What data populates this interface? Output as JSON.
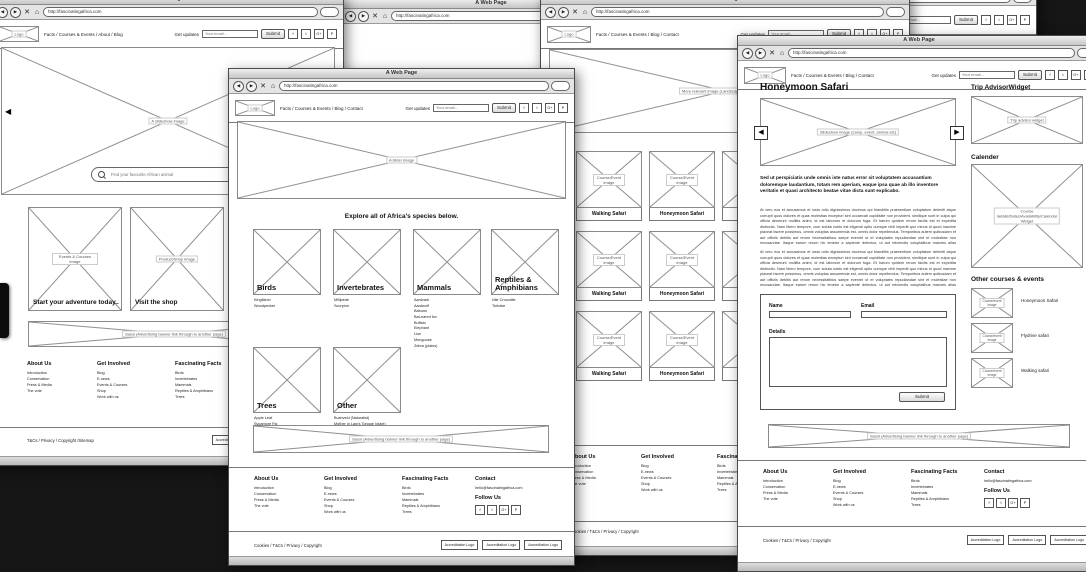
{
  "chrome": {
    "title": "A Web Page",
    "url": "http://fascinatingafrica.com",
    "back": "◀",
    "forward": "▶",
    "close": "✕",
    "home": "⌂"
  },
  "header": {
    "logo_caption": "Logo",
    "nav_home": "Facts / Courses & Events / About / Blog",
    "nav_inner": "Facts / Courses & Events / Blog / Contact",
    "updates_label": "Get updates",
    "email_placeholder": "Your email...",
    "submit_label": "Submit",
    "social": [
      "f",
      "t",
      "G+",
      "P"
    ]
  },
  "footer": {
    "about": {
      "title": "About Us",
      "links": [
        "Introduction",
        "Conservation",
        "Press & Media",
        "The vote"
      ]
    },
    "involved": {
      "title": "Get Involved",
      "links": [
        "Blog",
        "E-news",
        "Events & Courses",
        "Shop",
        "Work with us"
      ]
    },
    "facts": {
      "title": "Fascinating Facts",
      "links": [
        "Birds",
        "Invertebrates",
        "Mammals",
        "Reptiles & Amphibians",
        "Trees"
      ]
    },
    "contact": {
      "title": "Contact",
      "email": "hello@fascinatingafrica.com",
      "follow": "Follow Us",
      "social": [
        "f",
        "t",
        "G+",
        "P"
      ]
    },
    "legal_inner": "Cookies / T&Cs / Privacy / Copyright",
    "legal_home": "T&Cs / Privacy / Copyright /Sitemap",
    "accreditation_label": "Accreditation Logo"
  },
  "banner": {
    "caption": "Sasol (Advertising banner link through to another page)"
  },
  "home": {
    "hero_caption": "A slideshow image",
    "prev_icon": "◀",
    "search_placeholder": "Find your favourite African animal",
    "cards": [
      {
        "caption": "Events & Courses image",
        "label": "Start your adventure today.."
      },
      {
        "caption": "Product/Shop image",
        "label": "Visit the shop"
      }
    ]
  },
  "species": {
    "hero_caption": "A slider image",
    "heading": "Explore all of Africa's species below.",
    "cats": [
      {
        "name": "Birds",
        "items": [
          "Kingfisher",
          "Woodpecker"
        ]
      },
      {
        "name": "Invertebrates",
        "items": [
          "Millipede",
          "Scorpion"
        ]
      },
      {
        "name": "Mammals",
        "items": [
          "Aardvark",
          "Aardwolf",
          "Baboon",
          "Bat-eared fox",
          "Buffalo",
          "Elephant",
          "Lion",
          "Mongoose",
          "Zebra (plains)"
        ]
      },
      {
        "name": "Reptiles & Amphibians",
        "items": [
          "Nile Crocodile",
          "Tortoise"
        ]
      },
      {
        "name": "Trees",
        "items": [
          "Apple Leaf",
          "Sycamore Fig"
        ]
      },
      {
        "name": "Other",
        "items": [
          "Bushveld (Naturalist)",
          "Mother in Law's Tongue (plant)"
        ]
      }
    ]
  },
  "courses": {
    "hero_caption": "More relevant image (Landscape, people, safari)",
    "card_caption": "Course/Event image",
    "labels": [
      "Walking Safari",
      "Honeymoon Safari",
      "Flydrive Safari"
    ]
  },
  "detail": {
    "title": "Honeymoon Safari",
    "slideshow_caption": "Slideshow image (camp, event, animal etc)",
    "prev_icon": "◀",
    "next_icon": "▶",
    "intro": "Sed ut perspiciatis unde omnis iste natus error sit voluptatem accusantium doloremque laudantium, totam rem aperiam, eaque ipsa quae ab illo inventore veritatis et quasi architecto beatae vitae dicta sunt explicabo.",
    "para": "At vero eos et accusamus et iusto odio dignissimos ducimus qui blanditiis praesentium voluptatum deleniti atque corrupti quos dolores et quas molestias excepturi sint occaecati cupiditate non provident, similique sunt in culpa qui officia deserunt mollitia animi, id est laborum et dolorum fuga. Et harum quidem rerum facilis est et expedita distinctio. Nam libero tempore, cum soluta nobis est eligendi optio cumque nihil impedit quo minus id quod maxime placeat facere possimus, omnis voluptas assumenda est, omnis dolor repellendus. Temporibus autem quibusdam et aut officiis debitis aut rerum necessitatibus saepe eveniet ut et voluptates repudiandae sint et molestiae non recusandae. Itaque earum rerum hic tenetur a sapiente delectus, ut aut reiciendis voluptatibus maiores alias consequatur aut perferendis doloribus asperiores repellat.",
    "form": {
      "name_label": "Name",
      "email_label": "Email",
      "details_label": "Details",
      "submit_label": "Submit"
    },
    "sidebar": {
      "trip_title": "Trip AdvisorWidget",
      "trip_caption": "Trip advisor widget",
      "cal_title": "Calender",
      "cal_caption": "Course details/Dates/Availability/Calendar Widget",
      "other_title": "Other courses & events",
      "other_caption": "Course/event image",
      "other_items": [
        "Honeymoon Safari",
        "Flydrive safari",
        "Walking safari"
      ]
    }
  }
}
